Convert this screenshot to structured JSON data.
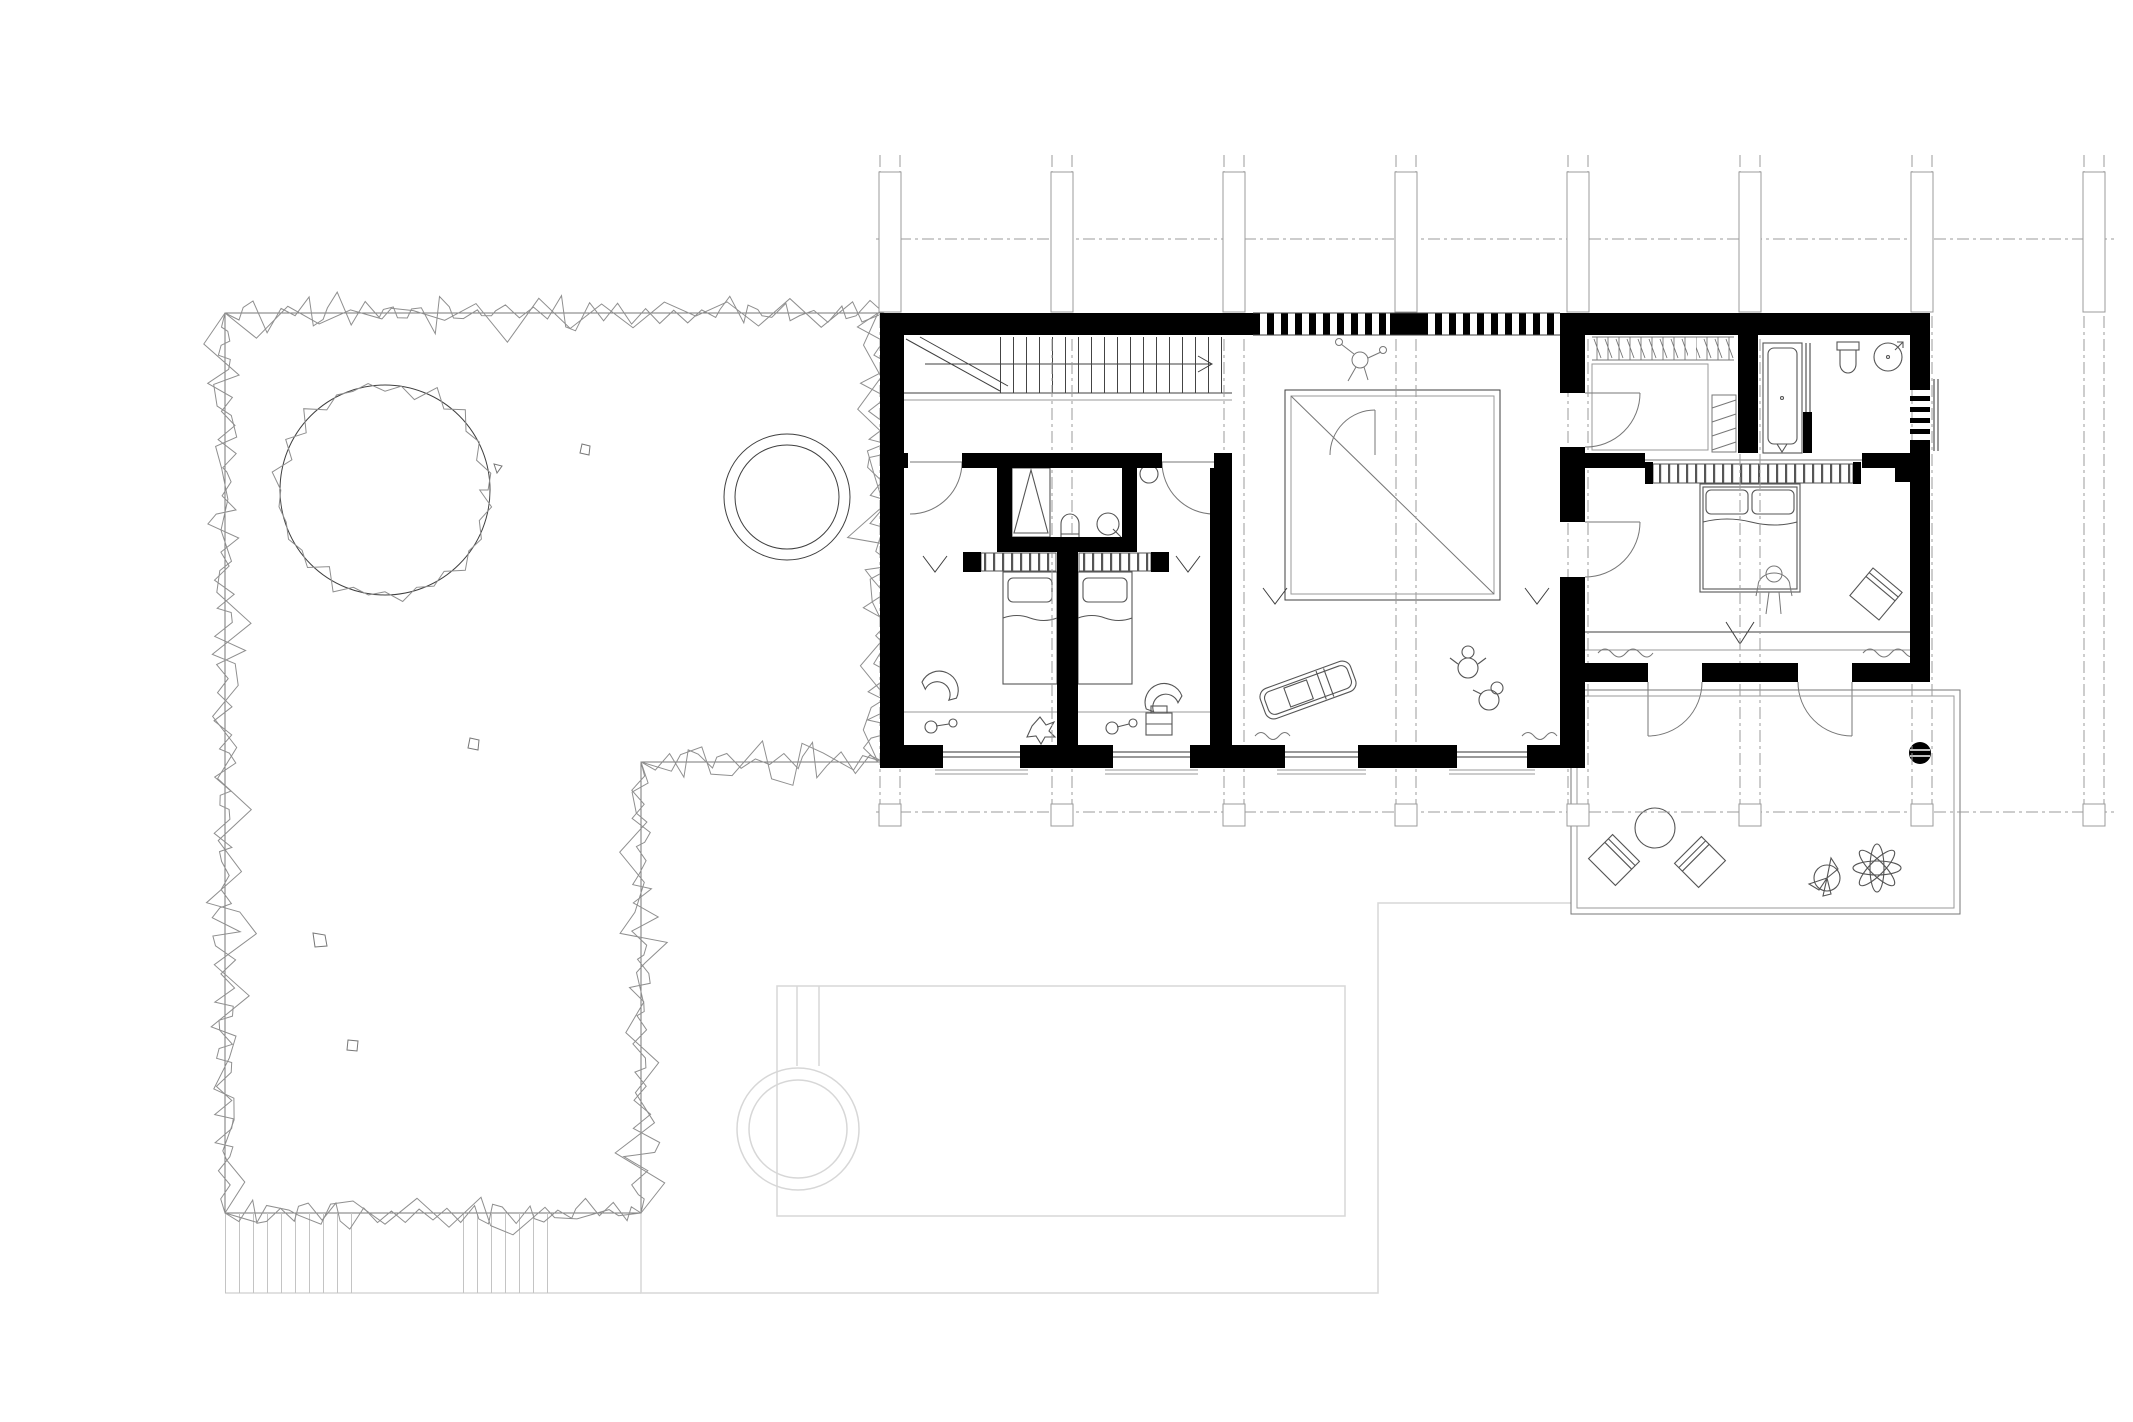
{
  "drawing": {
    "kind": "architectural-floor-plan",
    "has_text_labels": false
  },
  "colors": {
    "background": "#ffffff",
    "wall": "#000000",
    "ink": "#3f3f3f",
    "mid": "#777777",
    "light": "#9a9a9a",
    "ghost": "#d7d7d7",
    "hedge": "#8f8f8f",
    "grid": "#9b9b9b",
    "furniture": "#555555"
  },
  "grid": {
    "vertical_band_centers": [
      890,
      1062,
      1234,
      1406,
      1578,
      1750,
      1922,
      2094
    ],
    "band_half_gap": 10,
    "top_y": 155,
    "bottom_y": 804,
    "column_marker_top_y": 172,
    "column_marker_bottom_y": 312,
    "end_square_y": 804,
    "end_square_size": 22,
    "horizontal_lines": [
      {
        "y": 239,
        "x1": 876,
        "x2": 2114
      },
      {
        "y": 812,
        "x1": 876,
        "x2": 2114
      }
    ]
  },
  "site": {
    "hedge_segments": [
      [
        225,
        313,
        884,
        313
      ],
      [
        225,
        313,
        225,
        1213
      ],
      [
        225,
        1213,
        641,
        1213
      ],
      [
        641,
        1213,
        641,
        762
      ],
      [
        641,
        762,
        884,
        762
      ],
      [
        878,
        313,
        878,
        762
      ]
    ],
    "large_tree": {
      "cx": 385,
      "cy": 490,
      "r": 105
    },
    "small_tree": {
      "cx": 787,
      "cy": 497,
      "r_outer": 63,
      "r_inner": 52
    }
  },
  "symbols": [
    "hedge-boundary",
    "large-tree",
    "small-tree",
    "garden-rocks",
    "garden-steps-hatch",
    "structural-grid",
    "column-markers",
    "staircase",
    "stair-direction-arrow",
    "walking-person",
    "kids-bathroom",
    "shower",
    "toilet",
    "washbasin",
    "children-bed",
    "chair",
    "toys",
    "open-void",
    "toy-car",
    "playing-children",
    "window",
    "louvre-band",
    "curtain",
    "entry-arrow",
    "walk-in-closet",
    "bathtub",
    "shower-round",
    "master-bed",
    "standing-person",
    "french-door",
    "terrace",
    "lounge-chair",
    "round-table",
    "potted-plant",
    "column-dot",
    "ghost-pool",
    "ghost-hot-tub",
    "ghost-ground-floor-outline",
    "wardrobe"
  ]
}
